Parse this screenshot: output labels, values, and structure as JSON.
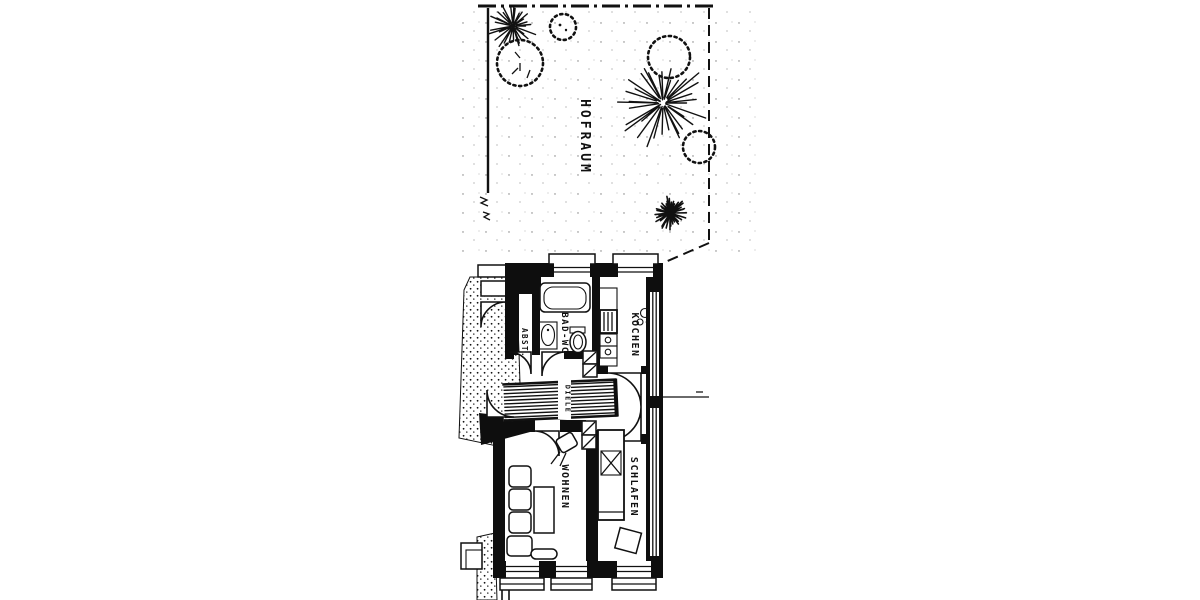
{
  "plan": {
    "site_label": "HOFRAUM",
    "rooms": {
      "abst": {
        "label": "ABST."
      },
      "bad": {
        "label": "BAD-WC"
      },
      "kochen": {
        "label": "KOCHEN"
      },
      "diele": {
        "label": "DIELE"
      },
      "wohnen": {
        "label": "WOHNEN"
      },
      "schlafen": {
        "label": "SCHLAFEN"
      }
    },
    "colors": {
      "ink": "#111111",
      "paper": "#ffffff"
    }
  }
}
